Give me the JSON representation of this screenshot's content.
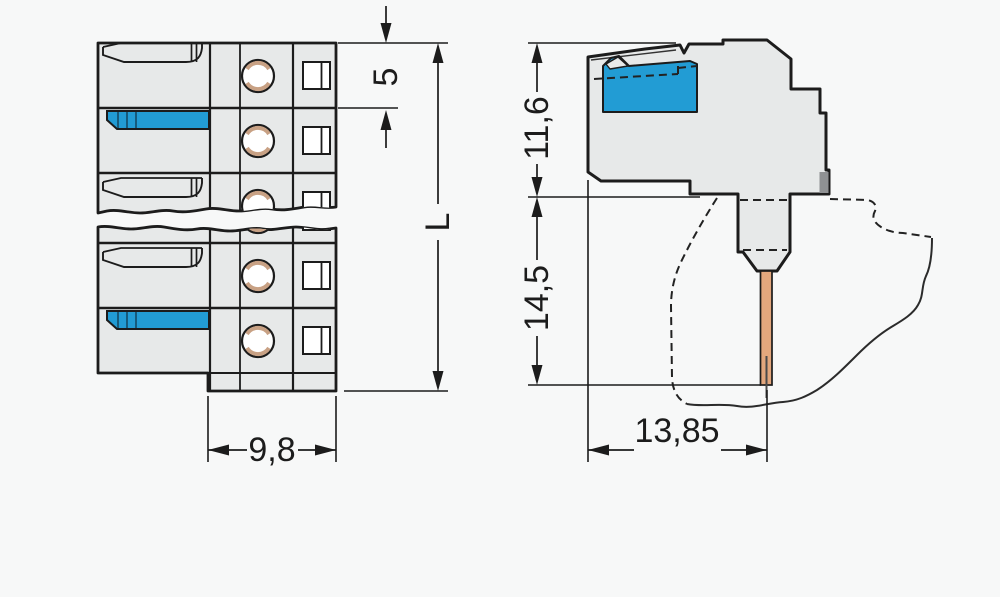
{
  "drawing": {
    "type": "technical-dimension-drawing",
    "colors": {
      "background": "#f7f8f8",
      "line": "#1c1c1c",
      "body_fill": "#e7e9e9",
      "highlight_blue": "#229cd4",
      "pin_copper": "#e3a77d",
      "clamp_shade_tan": "#c8a184",
      "panel_block_gray": "#8f9193"
    },
    "front_view": {
      "dimensions": {
        "pole_pitch": "5",
        "total_length": "L",
        "housing_width": "9,8"
      }
    },
    "side_view": {
      "dimensions": {
        "height_upper": "11,6",
        "height_lower": "14,5",
        "depth": "13,85"
      }
    }
  }
}
